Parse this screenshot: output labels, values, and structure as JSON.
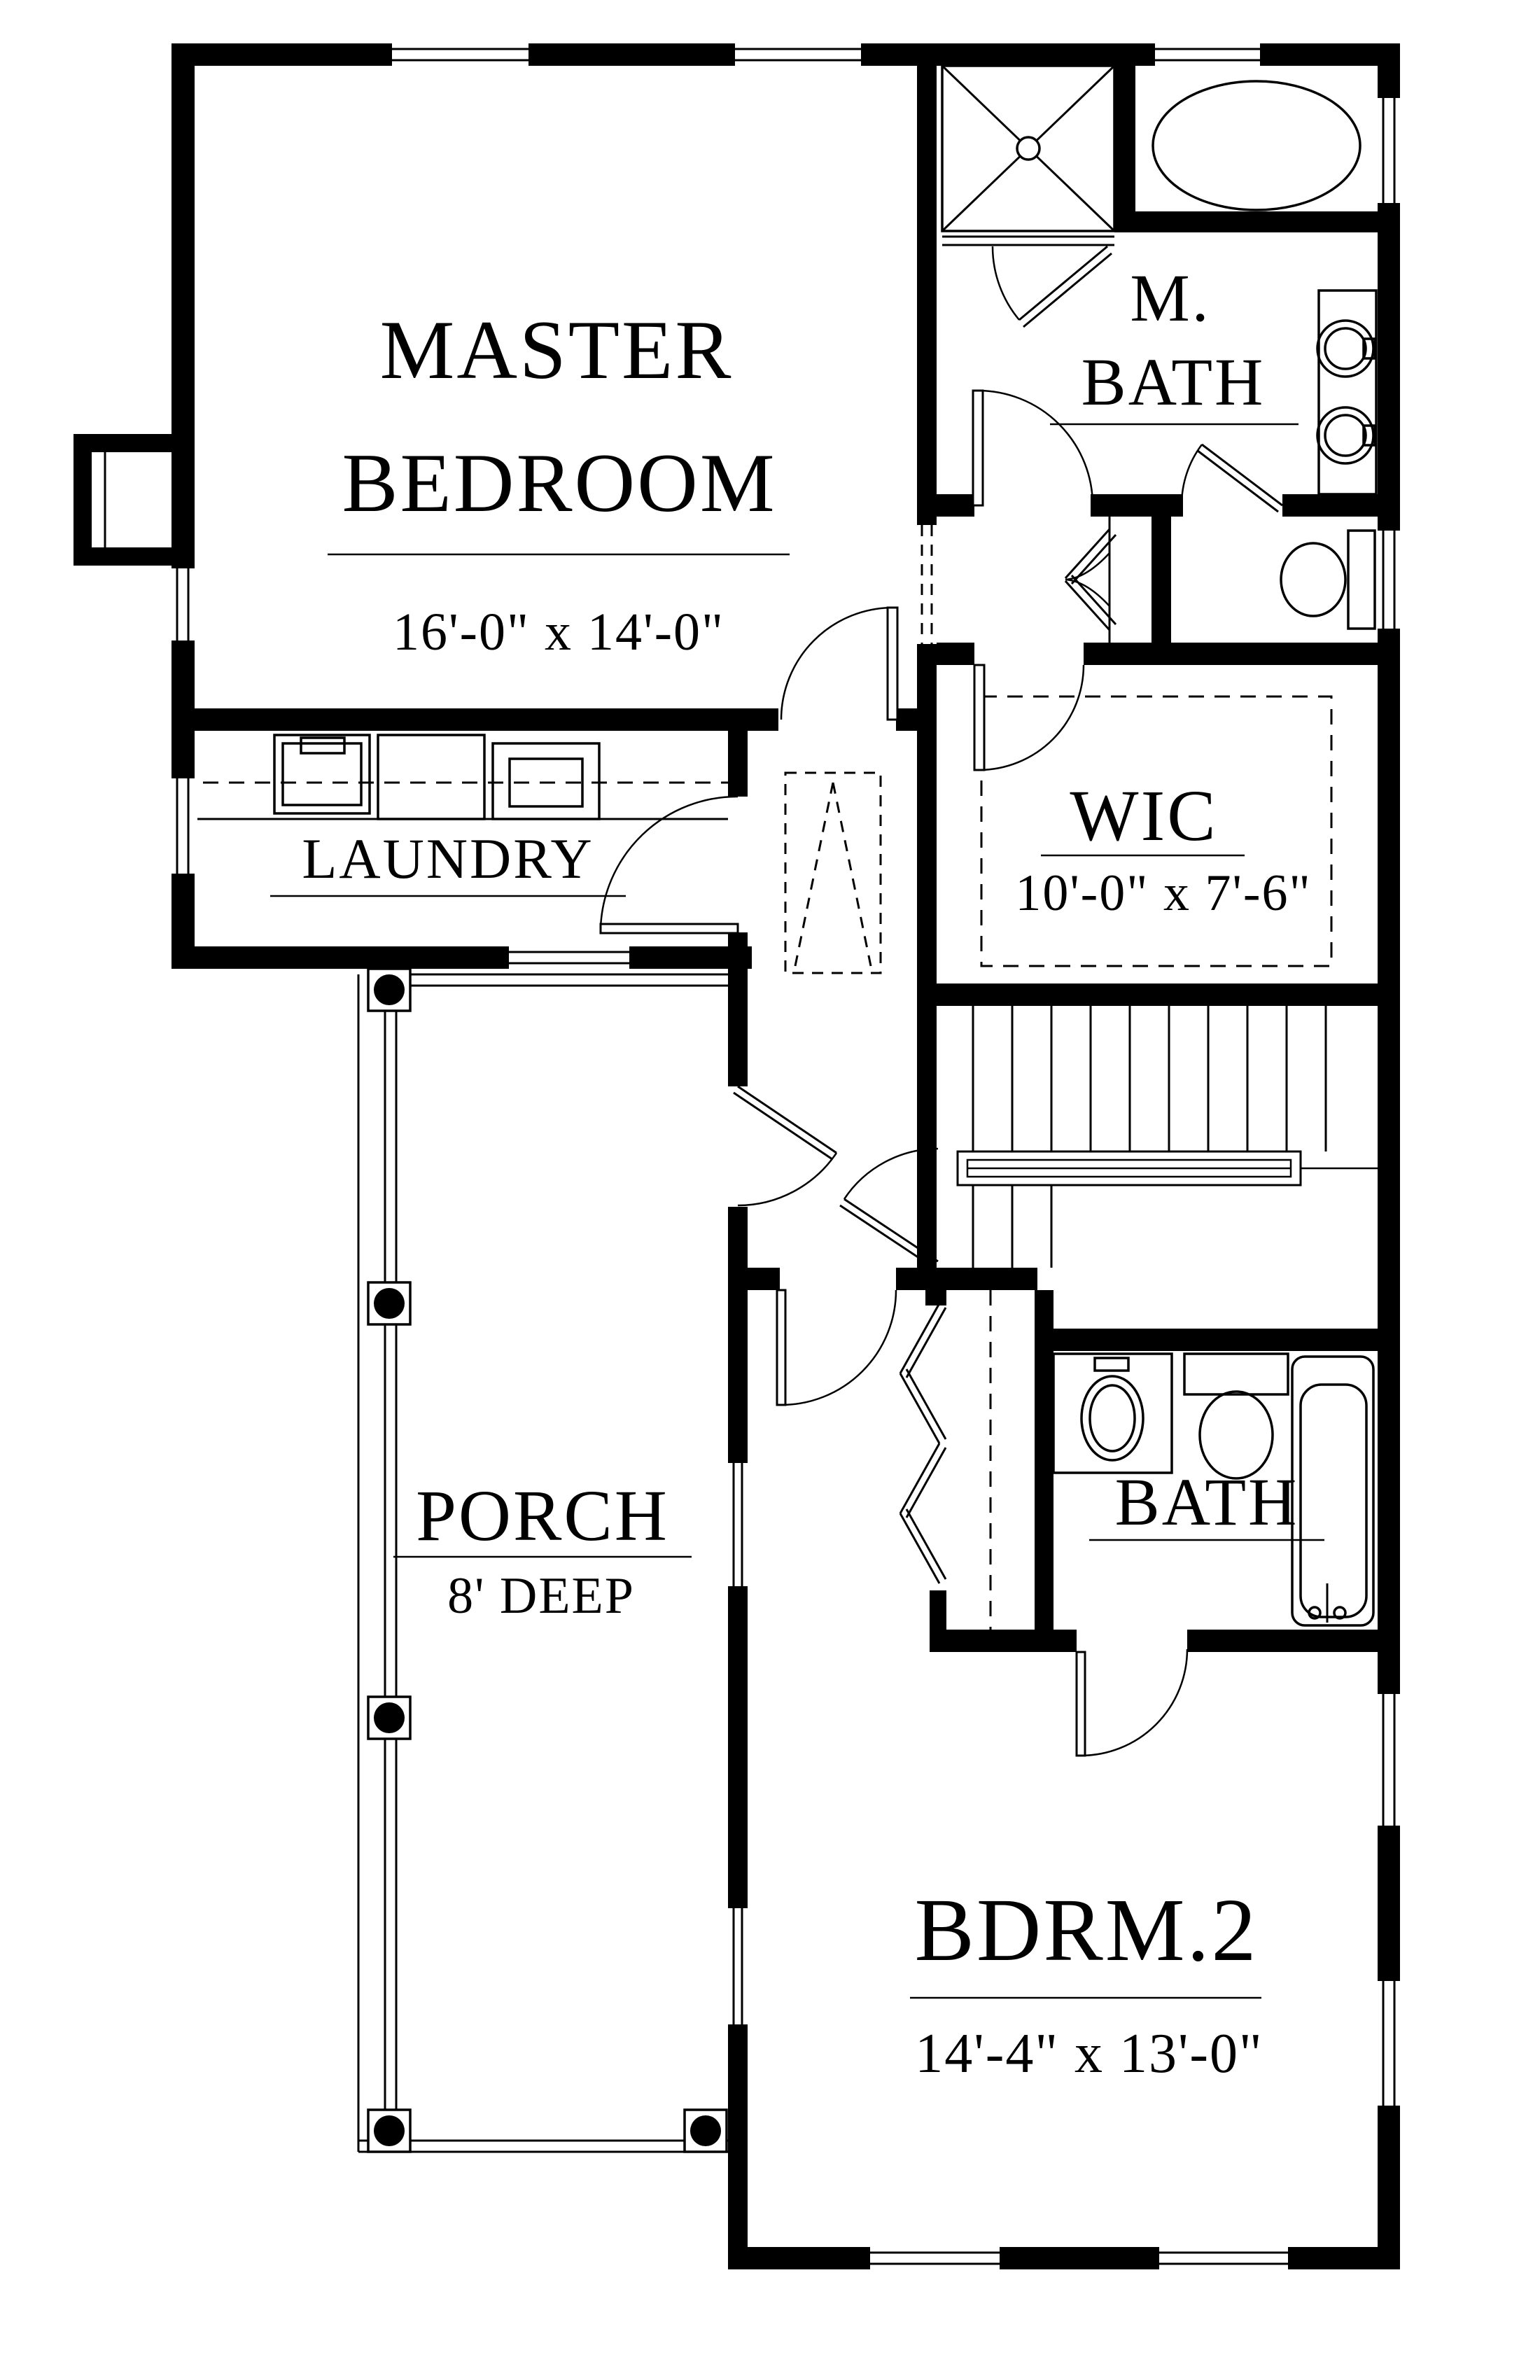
{
  "drawing": {
    "title": "Second floor plan",
    "paper_color": "#ffffff",
    "ink_color": "#000000"
  },
  "rooms": {
    "master_bedroom": {
      "label_line1": "MASTER",
      "label_line2": "BEDROOM",
      "dimensions": "16'-0\" x 14'-0\""
    },
    "master_bath": {
      "label_line1": "M.",
      "label_line2": "BATH"
    },
    "wic": {
      "label": "WIC",
      "dimensions": "10'-0\" x 7'-6\""
    },
    "laundry": {
      "label": "LAUNDRY"
    },
    "porch": {
      "label": "PORCH",
      "depth": "8' DEEP"
    },
    "bath": {
      "label": "BATH"
    },
    "bedroom2": {
      "label": "BDRM.2",
      "dimensions": "14'-4\" x 13'-0\""
    }
  }
}
